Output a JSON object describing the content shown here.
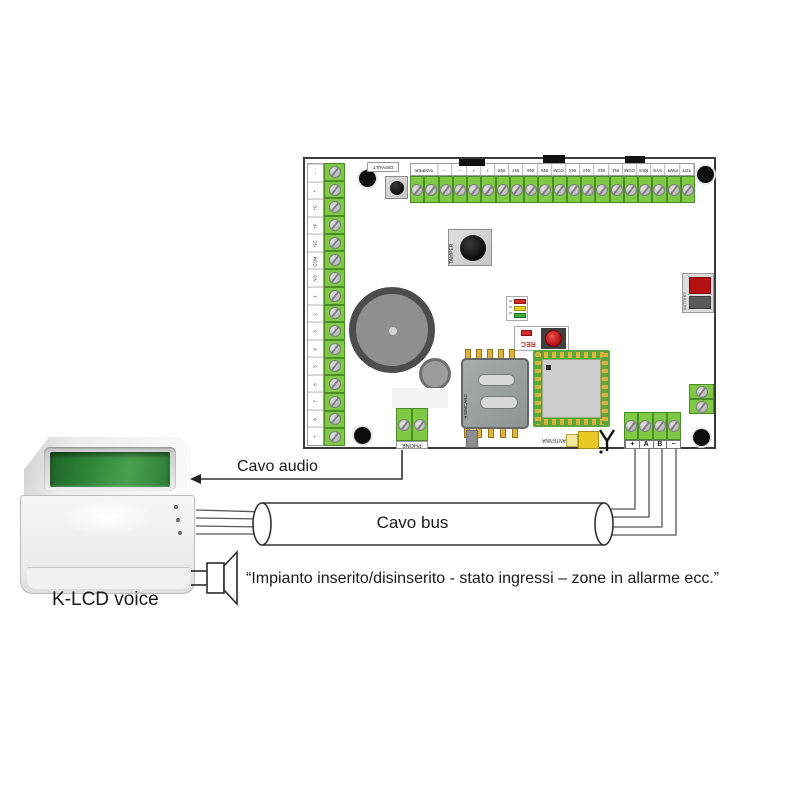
{
  "diagram": {
    "cavo_audio_label": "Cavo audio",
    "cavo_bus_label": "Cavo bus",
    "keypad_label": "K-LCD voice",
    "speech_text": "“Impianto inserito/disinserito - stato ingressi – zone in allarme ecc.”"
  },
  "board": {
    "top_terminal_labels": [
      "TAMPER",
      "−",
      "−",
      "+",
      "+",
      "IN8",
      "IN7",
      "IN6",
      "IN5",
      "COM",
      "IN4",
      "IN3",
      "IN2",
      "IN1",
      "COM",
      "RES",
      "SYS",
      "PWR",
      "TOT"
    ],
    "left_terminal_labels": [
      "−",
      "+",
      "+C",
      "+F",
      "NC",
      "COM",
      "NO",
      "1",
      "2",
      "3",
      "4",
      "5",
      "6",
      "7",
      "8",
      "+"
    ],
    "bus_terminal_labels": [
      "+",
      "A",
      "B",
      "−"
    ],
    "phone_label": "PHONE",
    "antenna_label": "ANTENNA",
    "battery_label": "BATTERY",
    "sim_label": "SIMCARD",
    "rec_label": "REC",
    "tamper_label": "TAMPER",
    "default_label": "DEFAULT"
  },
  "colors": {
    "terminal_green": "#7dc943",
    "module_green": "#5aa53c",
    "lcd_green": "#2f8338",
    "led_red": "#d42b2b",
    "led_yellow": "#e8d229",
    "led_green": "#3fae3a",
    "battery_red": "#b51111",
    "rec_button_red": "#cc1111",
    "wire_color": "#333333"
  }
}
